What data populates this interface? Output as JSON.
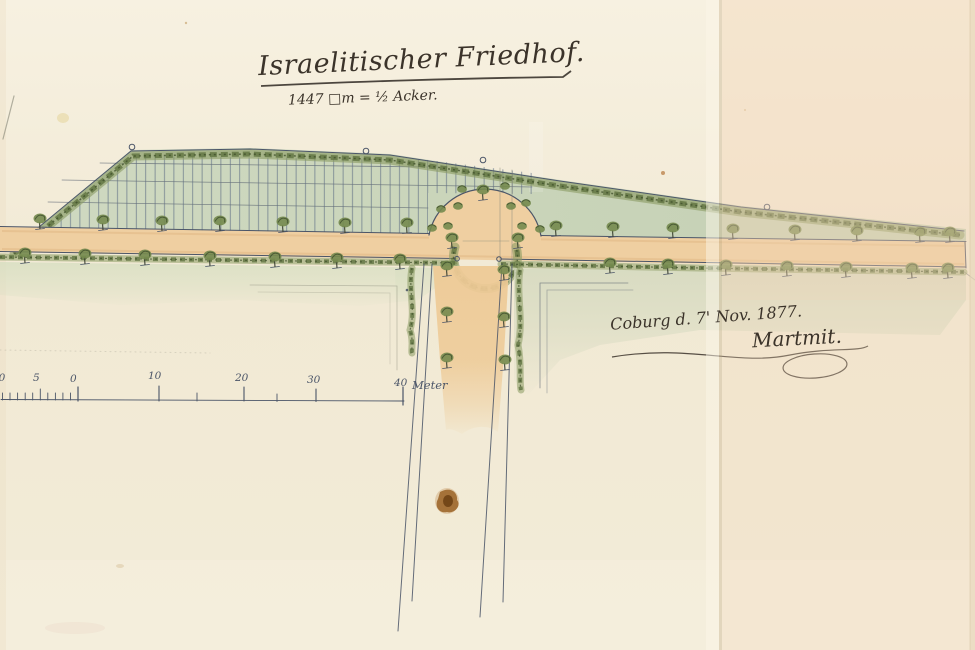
{
  "document": {
    "title": "Israelitischer Friedhof.",
    "area_note": "1447 □m = ½ Acker.",
    "place_date": "Coburg d. 7' Nov. 1877.",
    "signature": "Martmit."
  },
  "scale_bar": {
    "unit_label": "Meter",
    "ticks": [
      "10",
      "5",
      "0",
      "10",
      "20",
      "30",
      "40"
    ]
  },
  "colors": {
    "paper": "#f2ebd7",
    "paper_right_fold": "#f6e3cc",
    "field_green": "#ccd7bd",
    "hedge_green": "#5f7340",
    "hedge_dark": "#3d4d2a",
    "tree_green": "#74894e",
    "path_tan": "#efcfa1",
    "road_tan": "#eeca96",
    "ink": "#4b5568",
    "pencil": "#8b8b7b",
    "handwriting": "#3b332a",
    "stain_brown": "#8a5a20"
  }
}
